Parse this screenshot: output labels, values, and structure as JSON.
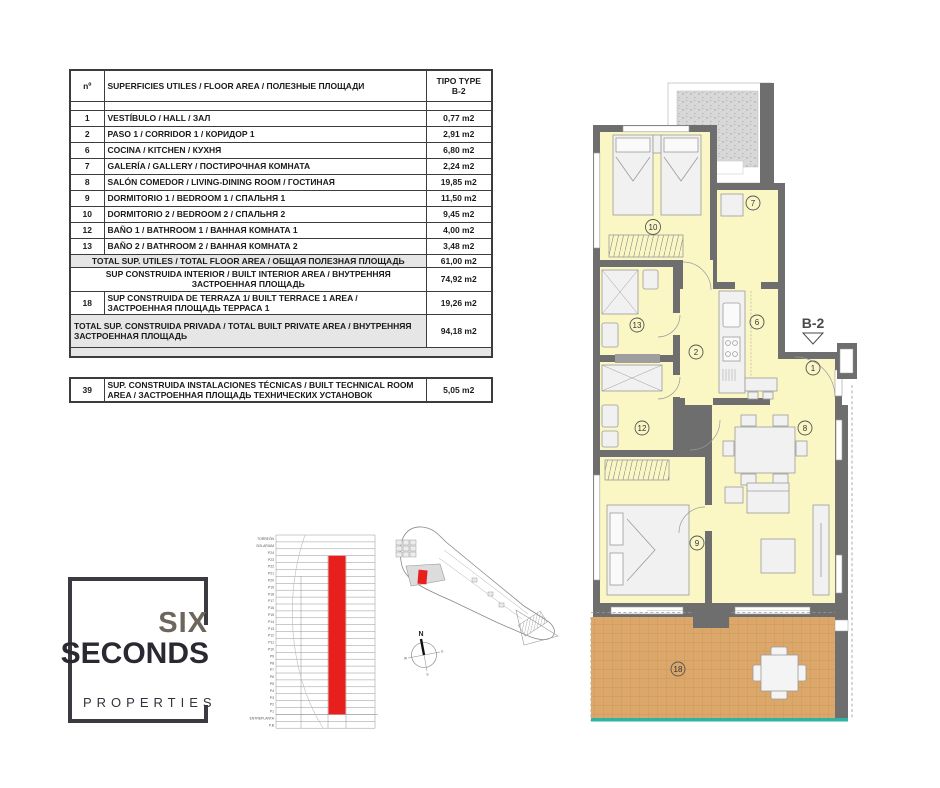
{
  "colors": {
    "wall": "#6e6e6e",
    "room_fill": "#faf7c5",
    "terrace_fill": "#dca76b",
    "terrace_grid": "#c7934f",
    "teal_edge": "#2fb3a3",
    "highlight_red": "#e8201d",
    "table_border": "#3c3c3c",
    "total_row_bg": "#e6e6e6",
    "speckle": "#d8d8d8"
  },
  "table": {
    "header": {
      "num": "nº",
      "desc": "SUPERFICIES UTILES / FLOOR AREA / ПОЛЕЗНЫЕ ПЛОЩАДИ",
      "type_line1": "TIPO TYPE",
      "type_line2": "B-2"
    },
    "rows": [
      {
        "num": "1",
        "desc": "VESTÍBULO / HALL / ЗАЛ",
        "value": "0,77 m2"
      },
      {
        "num": "2",
        "desc": "PASO 1 /  CORRIDOR 1 / КОРИДОР 1",
        "value": "2,91 m2"
      },
      {
        "num": "6",
        "desc": "COCINA / KITCHEN / КУХНЯ",
        "value": "6,80 m2"
      },
      {
        "num": "7",
        "desc": "GALERÍA / GALLERY / ПОСТИРОЧНАЯ КОМНАТА",
        "value": "2,24 m2"
      },
      {
        "num": "8",
        "desc": "SALÓN COMEDOR  / LIVING-DINING ROOM / ГОСТИНАЯ",
        "value": "19,85 m2"
      },
      {
        "num": "9",
        "desc": "DORMITORIO 1 / BEDROOM 1 / СПАЛЬНЯ 1",
        "value": "11,50 m2"
      },
      {
        "num": "10",
        "desc": "DORMITORIO 2 / BEDROOM 2 / СПАЛЬНЯ 2",
        "value": "9,45 m2"
      },
      {
        "num": "12",
        "desc": "BAÑO 1 / BATHROOM 1 / ВАННАЯ КОМНАТА 1",
        "value": "4,00 m2"
      },
      {
        "num": "13",
        "desc": "BAÑO 2 / BATHROOM 2 / ВАННАЯ КОМНАТА 2",
        "value": "3,48 m2"
      }
    ],
    "total_useful": {
      "desc": "TOTAL SUP. UTILES / TOTAL FLOOR AREA / ОБЩАЯ ПОЛЕЗНАЯ ПЛОЩАДЬ",
      "value": "61,00 m2"
    },
    "built_interior": {
      "desc": "SUP CONSTRUIDA INTERIOR / BUILT INTERIOR AREA / ВНУТРЕННЯЯ ЗАСТРОЕННАЯ ПЛОЩАДЬ",
      "value": "74,92 m2"
    },
    "terrace": {
      "num": "18",
      "desc": "SUP CONSTRUIDA DE TERRAZA 1/ BUILT TERRACE 1 AREA / ЗАСТРОЕННАЯ ПЛОЩАДЬ ТЕРРАСА  1",
      "value": "19,26 m2"
    },
    "total_private": {
      "desc": "TOTAL  SUP. CONSTRUIDA PRIVADA / TOTAL  BUILT PRIVATE AREA / ВНУТРЕННЯЯ ЗАСТРОЕННАЯ ПЛОЩАДЬ",
      "value": "94,18 m2"
    },
    "technical": {
      "num": "39",
      "desc": "SUP. CONSTRUIDA INSTALACIONES TÉCNICAS / BUILT TECHNICAL  ROOM AREA / ЗАСТРОЕННАЯ ПЛОЩАДЬ ТЕХНИЧЕСКИХ УСТАНОВОК",
      "value": "5,05 m2"
    }
  },
  "logo": {
    "line1": "SIX",
    "line2": "SECONDS",
    "line3": "PROPERTIES"
  },
  "elevation": {
    "floors": [
      "TORREÓN",
      "SOLARIUM",
      "P24",
      "P23",
      "P22",
      "P21",
      "P20",
      "P19",
      "P18",
      "P17",
      "P16",
      "P15",
      "P14",
      "P13",
      "P12",
      "P11",
      "P10",
      "P9",
      "P8",
      "P7",
      "P6",
      "P5",
      "P4",
      "P3",
      "P2",
      "P1",
      "ENTREPLANTA",
      "P.B"
    ],
    "highlighted_floors": "P1–P23"
  },
  "compass": {
    "n": "N",
    "e": "E",
    "w": "W",
    "s": "S"
  },
  "plan": {
    "type_label": "B-2",
    "room_numbers": {
      "hall": "1",
      "corridor": "2",
      "kitchen": "6",
      "gallery": "7",
      "living": "8",
      "bedroom1": "9",
      "bedroom2": "10",
      "bath1": "12",
      "bath2": "13",
      "terrace": "18"
    }
  }
}
